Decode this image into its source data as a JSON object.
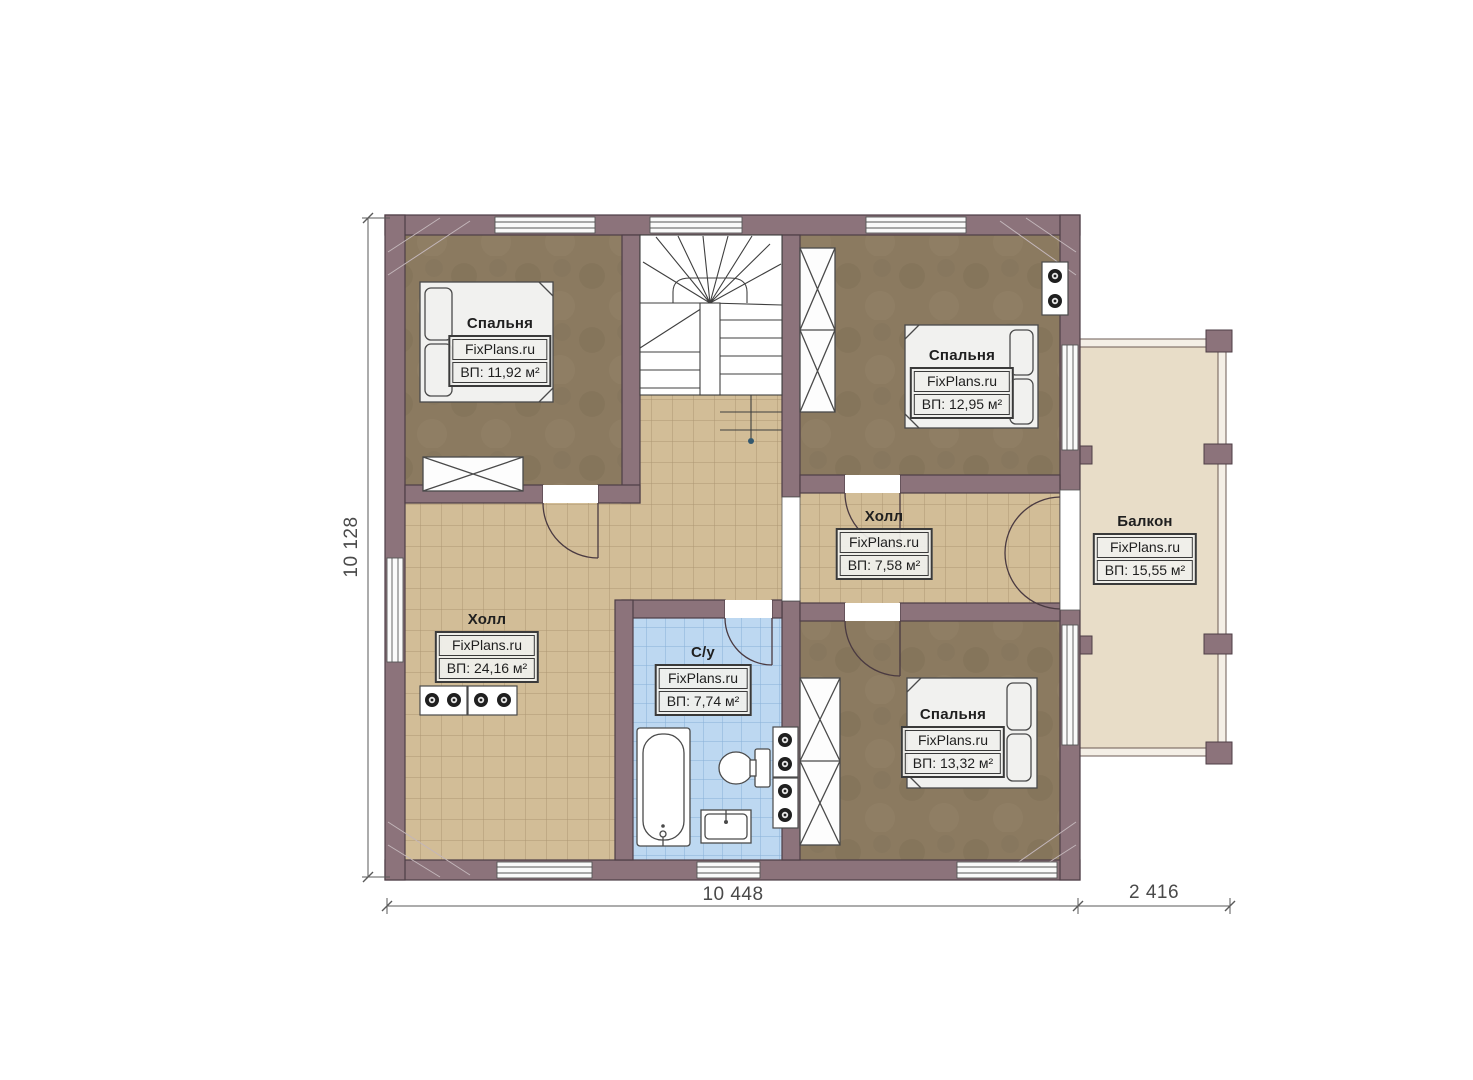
{
  "plan": {
    "rooms": {
      "bedroom_top_left": {
        "name": "Спальня",
        "brand": "FixPlans.ru",
        "area": "ВП: 11,92 м²"
      },
      "bedroom_top_right": {
        "name": "Спальня",
        "brand": "FixPlans.ru",
        "area": "ВП: 12,95 м²"
      },
      "hall_small": {
        "name": "Холл",
        "brand": "FixPlans.ru",
        "area": "ВП: 7,58 м²"
      },
      "balcony": {
        "name": "Балкон",
        "brand": "FixPlans.ru",
        "area": "ВП: 15,55 м²"
      },
      "hall_main": {
        "name": "Холл",
        "brand": "FixPlans.ru",
        "area": "ВП: 24,16 м²"
      },
      "bathroom": {
        "name": "С/у",
        "brand": "FixPlans.ru",
        "area": "ВП: 7,74 м²"
      },
      "bedroom_bottom_right": {
        "name": "Спальня",
        "brand": "FixPlans.ru",
        "area": "ВП: 13,32 м²"
      }
    },
    "dimensions": {
      "left_height": "10 128",
      "bottom_width": "10 448",
      "balcony_width": "2 416"
    },
    "colors": {
      "wall": "#8c737b",
      "floor_tile_tan": "#d2bd97",
      "floor_wood_brown": "#8b7a60",
      "floor_tile_blue": "#bdd8f1",
      "floor_balcony": "#e8ddc8"
    }
  }
}
